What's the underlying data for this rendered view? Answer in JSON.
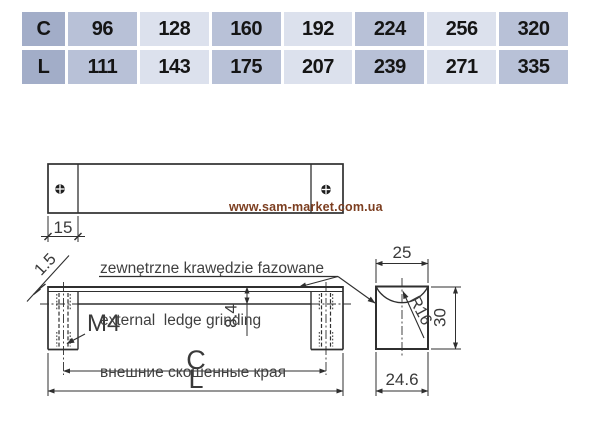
{
  "colors": {
    "table_header_bg": "#a2adc8",
    "table_cell_dark_bg": "#b8c1d7",
    "table_cell_light_bg": "#dce1ed",
    "line": "#2f2f2f",
    "watermark": "#7c3e20"
  },
  "table": {
    "rows": [
      {
        "header": "C",
        "values": [
          "96",
          "128",
          "160",
          "192",
          "224",
          "256",
          "320"
        ]
      },
      {
        "header": "L",
        "values": [
          "111",
          "143",
          "175",
          "207",
          "239",
          "271",
          "335"
        ]
      }
    ]
  },
  "watermark": "www.sam-market.com.ua",
  "annotation": {
    "line_pl": "zewnętrzne krawędzie fazowane",
    "line_en": "external  ledge grinding",
    "line_ru": "внешние скошенные края"
  },
  "dimensions": {
    "pad_width": "15",
    "chamfer": "1.5",
    "thread": "M4",
    "profile_height": "8.4",
    "hole_spacing": "C",
    "overall_length": "L",
    "top_depth": "25",
    "radius": "R16",
    "height": "30",
    "base_depth": "24.6"
  }
}
